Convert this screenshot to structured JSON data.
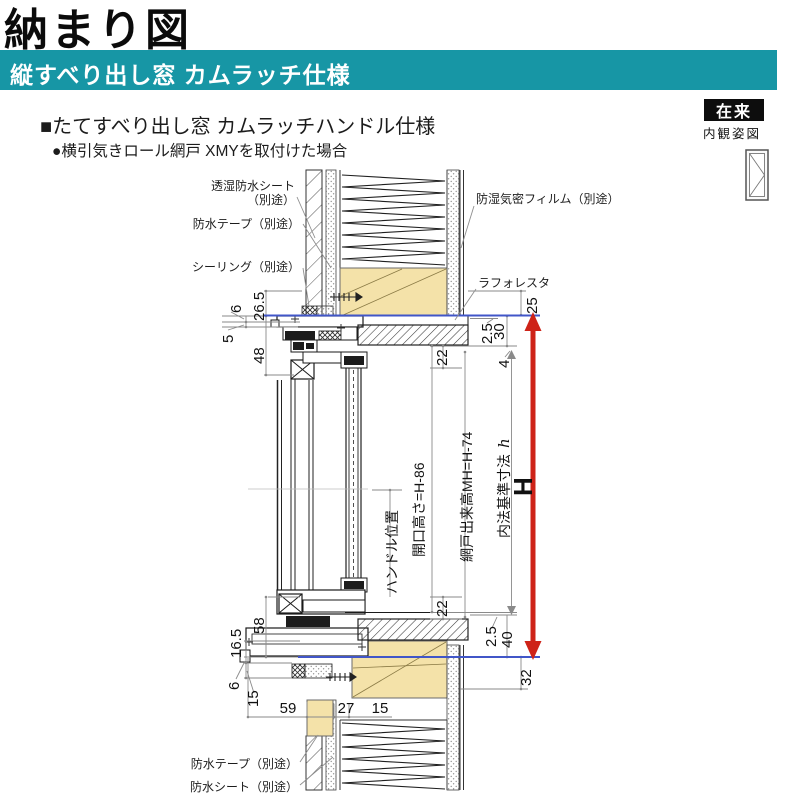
{
  "header": {
    "title": "納まり図",
    "banner": "縦すべり出し窓 カムラッチ仕様",
    "spec_heading": "■たてすべり出し窓 カムラッチハンドル仕様",
    "spec_note": "●横引気きロール網戸 XMYを取付けた場合",
    "construction_type": "在来",
    "view_label": "内観姿図"
  },
  "colors": {
    "banner_teal": "#1796A5",
    "wood_tan": "#F4E2A9",
    "reference_blue": "#4156C8",
    "dimension_red": "#CE2318"
  },
  "callouts": {
    "moisture_sheet_line1": "透湿防水シート",
    "moisture_sheet_line2": "（別途）",
    "water_tape_top": "防水テープ（別途）",
    "sealing": "シーリング（別途）",
    "vapor_film": "防湿気密フィルム（別途）",
    "laforesta": "ラフォレスタ",
    "water_tape_bottom": "防水テープ（別途）",
    "water_sheet_bottom": "防水シート（別途）"
  },
  "v_labels": {
    "handle": "ハンドル位置",
    "opening_height": "開口高さ=H-86",
    "screen_height": "網戸出来高MH=H-74",
    "inner_std": "内法基準寸法",
    "inner_std_symbol": "h",
    "overall": "H"
  },
  "dims": {
    "left_top": [
      "26.5",
      "6",
      "5",
      "48"
    ],
    "left_bottom": [
      "58",
      "16.5",
      "6",
      "15"
    ],
    "bottom_row": [
      "59",
      "27",
      "15"
    ],
    "right_top": [
      "2.5",
      "30",
      "4",
      "25"
    ],
    "right_bottom": [
      "2.5",
      "40",
      "32"
    ],
    "sash": [
      "22",
      "22"
    ]
  }
}
